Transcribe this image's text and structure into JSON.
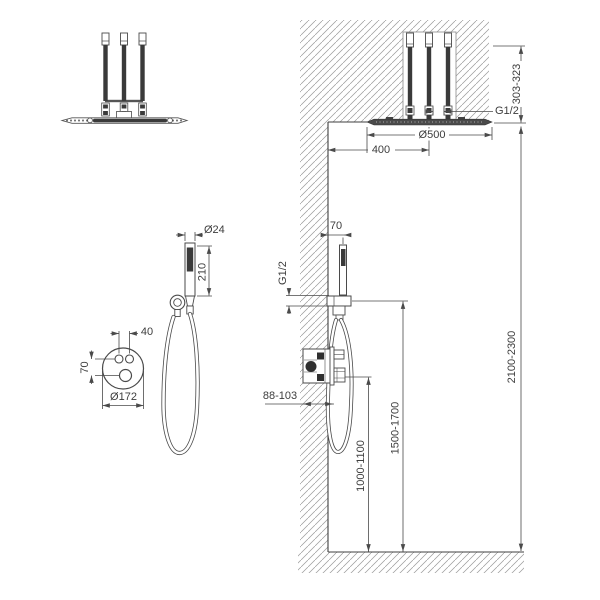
{
  "dimensions": {
    "ceiling_shower": {
      "arm_height": "303-323",
      "connection": "G1/2",
      "diameter": "Ø500",
      "wall_offset": "400"
    },
    "hand_shower": {
      "wall_offset": "70",
      "connection": "G1/2",
      "handle_diameter": "Ø24",
      "handle_length": "210"
    },
    "valve": {
      "embed_depth": "88-103",
      "height_from_floor": "1000-1100"
    },
    "holder": {
      "height_from_floor": "1500-1700"
    },
    "installation": {
      "head_height": "2100-2300"
    },
    "control_plate": {
      "diameter": "Ø172",
      "button_spacing": "40",
      "knob_offset": "70"
    }
  }
}
